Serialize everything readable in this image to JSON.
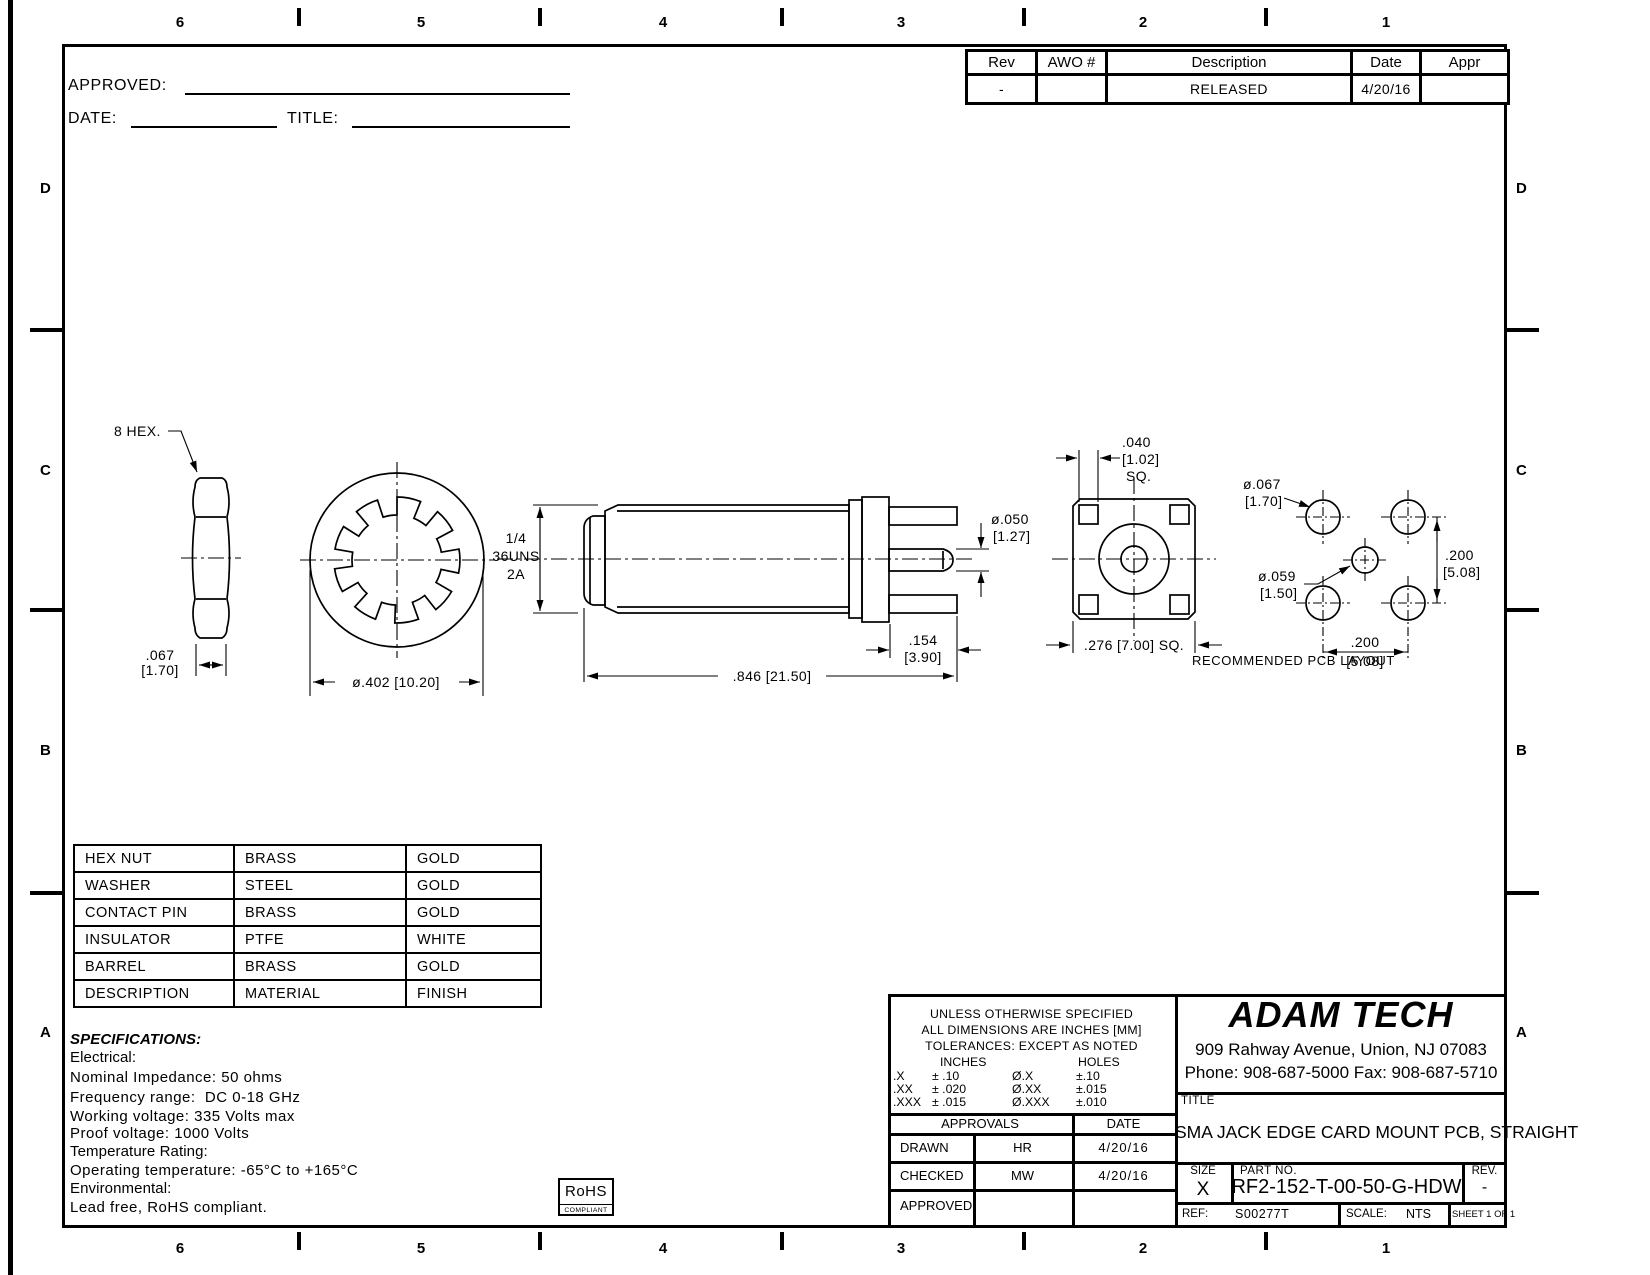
{
  "zones": {
    "cols": [
      "6",
      "5",
      "4",
      "3",
      "2",
      "1"
    ],
    "rows": [
      "D",
      "C",
      "B",
      "A"
    ]
  },
  "signoff": {
    "approved": "APPROVED:",
    "date": "DATE:",
    "title": "TITLE:"
  },
  "revision_table": {
    "col_rev": "Rev",
    "col_awo": "AWO #",
    "col_desc": "Description",
    "col_date": "Date",
    "col_appr": "Appr",
    "row": {
      "rev": "-",
      "awo": "",
      "desc": "RELEASED",
      "date": "4/20/16",
      "appr": ""
    }
  },
  "views": {
    "hex_nut": {
      "callout": "8 HEX.",
      "dim_in": ".067",
      "dim_mm": "[1.70]"
    },
    "washer": {
      "dim": "ø.402 [10.20]"
    },
    "barrel": {
      "thread1": "1/4",
      "thread2": "36UNS",
      "thread3": "2A",
      "pin_in": "ø.050",
      "pin_mm": "[1.27]",
      "tail_in": ".154",
      "tail_mm": "[3.90]",
      "len": ".846 [21.50]"
    },
    "flange": {
      "tab_in": ".040",
      "tab_mm": "[1.02]",
      "tab_sq": "SQ.",
      "sq": ".276 [7.00] SQ."
    },
    "pcb": {
      "hole_lg_in": "ø.067",
      "hole_lg_mm": "[1.70]",
      "hole_sm_in": "ø.059",
      "hole_sm_mm": "[1.50]",
      "pitch_v_in": ".200",
      "pitch_v_mm": "[5.08]",
      "pitch_h_in": ".200",
      "pitch_h_mm": "[5.08]",
      "caption": "RECOMMENDED PCB LAYOUT"
    }
  },
  "materials_table": {
    "rows": [
      [
        "HEX NUT",
        "BRASS",
        "GOLD"
      ],
      [
        "WASHER",
        "STEEL",
        "GOLD"
      ],
      [
        "CONTACT PIN",
        "BRASS",
        "GOLD"
      ],
      [
        "INSULATOR",
        "PTFE",
        "WHITE"
      ],
      [
        "BARREL",
        "BRASS",
        "GOLD"
      ],
      [
        "DESCRIPTION",
        "MATERIAL",
        "FINISH"
      ]
    ]
  },
  "specs": {
    "title": "SPECIFICATIONS:",
    "electrical": "Electrical:",
    "line1": "Nominal Impedance: 50 ohms",
    "line2": "Frequency range:  DC 0-18 GHz",
    "line3": "Working voltage: 335 Volts max",
    "line4": "Proof voltage: 1000 Volts",
    "temp": "Temperature Rating:",
    "line5": "Operating temperature: -65°C to +165°C",
    "env": "Environmental:",
    "line6": "Lead free, RoHS compliant."
  },
  "rohs": {
    "name": "RoHS",
    "sub": "COMPLIANT"
  },
  "tolerances": {
    "line1": "UNLESS OTHERWISE SPECIFIED",
    "line2": "ALL DIMENSIONS ARE INCHES [MM]",
    "line3": "TOLERANCES: EXCEPT AS NOTED",
    "inches": "INCHES",
    "holes": "HOLES",
    "rows": [
      [
        ".X",
        "± .10",
        "Ø.X",
        "±.10"
      ],
      [
        ".XX",
        "± .020",
        "Ø.XX",
        "±.015"
      ],
      [
        ".XXX",
        "± .015",
        "Ø.XXX",
        "±.010"
      ]
    ]
  },
  "approvals": {
    "header": "APPROVALS",
    "date_header": "DATE",
    "rows": [
      [
        "DRAWN",
        "HR",
        "4/20/16"
      ],
      [
        "CHECKED",
        "MW",
        "4/20/16"
      ],
      [
        "APPROVED",
        "",
        ""
      ]
    ]
  },
  "company": {
    "name": "ADAM TECH",
    "address": "909 Rahway Avenue, Union, NJ 07083",
    "phone": "Phone: 908-687-5000 Fax: 908-687-5710"
  },
  "title_block": {
    "title_label": "TITLE",
    "title": "SMA JACK EDGE CARD MOUNT PCB, STRAIGHT",
    "size_label": "SIZE",
    "size": "X",
    "part_label": "PART NO.",
    "part_no": "RF2-152-T-00-50-G-HDW",
    "rev_label": "REV.",
    "rev": "-",
    "ref_label": "REF:",
    "ref": "S00277T",
    "scale_label": "SCALE:",
    "scale": "NTS",
    "sheet": "SHEET 1 OF 1"
  }
}
